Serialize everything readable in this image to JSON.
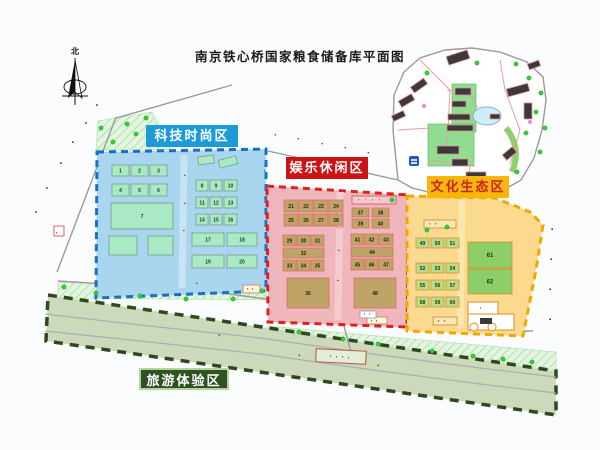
{
  "title": "南京铁心桥国家粮食储备库平面图",
  "compass_north": "北",
  "zones": {
    "tech": {
      "label": "科技时尚区",
      "label_bg": "#1e9bd7",
      "label_color": "#ffffff",
      "fill": "#aad5ee",
      "border": "#1a6fc9"
    },
    "fun": {
      "label": "娱乐休闲区",
      "label_bg": "#cc1414",
      "label_color": "#ffffff",
      "fill": "#efb6bc",
      "border": "#e02020"
    },
    "culture": {
      "label": "文化生态区",
      "label_bg": "#f6b70a",
      "label_color": "#cc2222",
      "fill": "#fbd98f",
      "border": "#f0a800"
    },
    "tour": {
      "label": "旅游体验区",
      "label_bg": "#2f5222",
      "label_color": "#ffffff",
      "fill": "#ccdabb",
      "border": "#2d4a1e"
    }
  },
  "map": {
    "buildings": {
      "bld-tech": {
        "name": "tech-zone-building",
        "fill": "#a9e9c3",
        "stroke": "#7a9c88",
        "text": "#123f22",
        "items": [
          [
            112,
            165,
            17,
            11,
            "1"
          ],
          [
            131,
            165,
            17,
            11,
            "2"
          ],
          [
            150,
            165,
            17,
            11,
            "3"
          ],
          [
            112,
            184,
            17,
            12,
            "4"
          ],
          [
            131,
            184,
            17,
            12,
            "5"
          ],
          [
            150,
            184,
            17,
            12,
            "6"
          ],
          [
            111,
            203,
            62,
            26,
            "7"
          ],
          [
            109,
            236,
            28,
            19,
            ""
          ],
          [
            148,
            236,
            25,
            19,
            ""
          ],
          [
            198,
            156,
            16,
            8,
            "",
            -8
          ],
          [
            219,
            158,
            18,
            8,
            "",
            -15
          ],
          [
            196,
            180,
            12,
            11,
            "8"
          ],
          [
            210,
            180,
            12,
            11,
            "9"
          ],
          [
            224,
            180,
            13,
            11,
            "10"
          ],
          [
            196,
            197,
            12,
            11,
            "11"
          ],
          [
            210,
            197,
            12,
            11,
            "12"
          ],
          [
            224,
            197,
            13,
            11,
            "13"
          ],
          [
            196,
            214,
            12,
            11,
            "14"
          ],
          [
            210,
            214,
            12,
            11,
            "15"
          ],
          [
            224,
            214,
            13,
            11,
            "16"
          ],
          [
            192,
            233,
            32,
            13,
            "17"
          ],
          [
            227,
            233,
            30,
            13,
            "18"
          ],
          [
            192,
            255,
            32,
            13,
            "19"
          ],
          [
            227,
            255,
            30,
            13,
            "20"
          ]
        ]
      },
      "bld-fun": {
        "name": "fun-zone-building",
        "fill": "#bfa468",
        "stroke": "#e06b6b",
        "text": "#2d1f08",
        "items": [
          [
            284,
            200,
            14,
            12,
            "21"
          ],
          [
            299,
            200,
            14,
            12,
            "22"
          ],
          [
            314,
            200,
            14,
            12,
            "23"
          ],
          [
            329,
            200,
            14,
            12,
            "24"
          ],
          [
            284,
            214,
            14,
            12,
            "25"
          ],
          [
            299,
            214,
            14,
            12,
            "26"
          ],
          [
            314,
            214,
            14,
            12,
            "27"
          ],
          [
            329,
            214,
            14,
            12,
            "28"
          ],
          [
            283,
            235,
            13,
            11,
            "29"
          ],
          [
            297,
            235,
            13,
            11,
            "30"
          ],
          [
            311,
            235,
            13,
            11,
            "31"
          ],
          [
            283,
            248,
            41,
            10,
            "32"
          ],
          [
            283,
            260,
            13,
            11,
            "33"
          ],
          [
            297,
            260,
            13,
            11,
            "34"
          ],
          [
            311,
            260,
            13,
            11,
            "35"
          ],
          [
            287,
            278,
            42,
            30,
            "36"
          ],
          [
            352,
            208,
            17,
            9,
            "37"
          ],
          [
            372,
            208,
            17,
            9,
            "38"
          ],
          [
            352,
            219,
            17,
            9,
            "39"
          ],
          [
            372,
            219,
            17,
            9,
            "40"
          ],
          [
            351,
            234,
            13,
            11,
            "41"
          ],
          [
            365,
            234,
            13,
            11,
            "42"
          ],
          [
            379,
            234,
            14,
            11,
            "43"
          ],
          [
            351,
            247,
            42,
            10,
            "44"
          ],
          [
            351,
            259,
            13,
            11,
            "45"
          ],
          [
            365,
            259,
            13,
            11,
            "46"
          ],
          [
            379,
            259,
            14,
            11,
            "47"
          ],
          [
            354,
            278,
            42,
            30,
            "48"
          ]
        ]
      },
      "bld-culture-small": {
        "name": "culture-zone-building",
        "fill": "#b5dd8a",
        "stroke": "#d98f2b",
        "text": "#333300",
        "items": [
          [
            416,
            238,
            13,
            10,
            "49"
          ],
          [
            431,
            238,
            13,
            10,
            "50"
          ],
          [
            446,
            238,
            13,
            10,
            "51"
          ],
          [
            416,
            263,
            13,
            10,
            "52"
          ],
          [
            431,
            263,
            13,
            10,
            "53"
          ],
          [
            446,
            263,
            13,
            10,
            "54"
          ],
          [
            416,
            280,
            13,
            10,
            "55"
          ],
          [
            431,
            280,
            13,
            10,
            "56"
          ],
          [
            446,
            280,
            13,
            10,
            "57"
          ],
          [
            416,
            297,
            13,
            10,
            "58"
          ],
          [
            431,
            297,
            13,
            10,
            "59"
          ],
          [
            446,
            297,
            13,
            10,
            "60"
          ]
        ]
      },
      "bld-culture-large": {
        "name": "culture-zone-field",
        "fill": "#8ccf6a",
        "stroke": "#d98f2b",
        "text": "#333300",
        "font": 6,
        "items": [
          [
            468,
            242,
            44,
            26,
            "61"
          ],
          [
            468,
            269,
            44,
            25,
            "62"
          ]
        ]
      },
      "bld-complex": {
        "name": "northeast-complex-building",
        "fill": "#3a3a3a",
        "stroke": "#e89090",
        "text": "#000000",
        "items": [
          [
            447,
            53,
            22,
            9,
            "",
            -18
          ],
          [
            528,
            62,
            12,
            6,
            "",
            -20
          ],
          [
            411,
            82,
            16,
            7,
            "",
            -35
          ],
          [
            399,
            97,
            15,
            7,
            "",
            -30
          ],
          [
            392,
            113,
            13,
            6,
            "",
            -25
          ],
          [
            455,
            88,
            16,
            7,
            ""
          ],
          [
            452,
            101,
            14,
            6,
            ""
          ],
          [
            448,
            114,
            22,
            6,
            ""
          ],
          [
            447,
            125,
            26,
            6,
            ""
          ],
          [
            437,
            146,
            22,
            8,
            ""
          ],
          [
            452,
            159,
            16,
            7,
            ""
          ],
          [
            507,
            86,
            22,
            8,
            "",
            -15
          ],
          [
            524,
            103,
            8,
            16,
            ""
          ],
          [
            503,
            150,
            13,
            7,
            "",
            -40
          ],
          [
            466,
            172,
            20,
            8,
            ""
          ],
          [
            438,
            177,
            17,
            7,
            ""
          ],
          [
            490,
            114,
            10,
            5,
            ""
          ]
        ]
      }
    },
    "trees": [
      [
        64,
        287
      ],
      [
        96,
        293
      ],
      [
        140,
        296
      ],
      [
        186,
        299
      ],
      [
        233,
        299
      ],
      [
        262,
        291
      ],
      [
        299,
        332
      ],
      [
        343,
        339
      ],
      [
        378,
        344
      ],
      [
        432,
        351
      ],
      [
        473,
        356
      ],
      [
        503,
        359
      ],
      [
        532,
        362
      ],
      [
        101,
        128
      ],
      [
        113,
        142
      ],
      [
        127,
        124
      ],
      [
        146,
        118
      ],
      [
        158,
        142
      ],
      [
        136,
        134
      ],
      [
        516,
        64
      ],
      [
        529,
        78
      ],
      [
        541,
        93
      ],
      [
        536,
        112
      ],
      [
        526,
        133
      ],
      [
        540,
        152
      ],
      [
        517,
        172
      ],
      [
        477,
        63
      ],
      [
        427,
        73
      ],
      [
        463,
        188
      ],
      [
        499,
        186
      ],
      [
        545,
        128
      ],
      [
        427,
        230
      ],
      [
        447,
        227
      ],
      [
        392,
        200
      ]
    ],
    "flowers": [
      [
        530,
        122
      ],
      [
        507,
        180
      ],
      [
        478,
        191
      ],
      [
        424,
        106
      ]
    ],
    "marks": {
      "left-road-name": {
        "name": "road-name-character",
        "glyph": "▪",
        "color": "#1c1c1c",
        "size": 6,
        "items": [
          [
            95,
            106,
            35
          ],
          [
            84,
            124,
            35
          ],
          [
            71,
            143,
            35
          ],
          [
            59,
            164,
            35
          ],
          [
            45,
            189,
            35
          ],
          [
            34,
            213,
            35
          ]
        ]
      },
      "mid-road-name": {
        "name": "road-name-character",
        "glyph": "▪",
        "color": "#1c1c1c",
        "size": 5,
        "items": [
          [
            274,
            136,
            15
          ],
          [
            297,
            140,
            15
          ],
          [
            321,
            145,
            15
          ],
          [
            344,
            149,
            15
          ],
          [
            367,
            154,
            15
          ]
        ]
      },
      "right-road-name": {
        "name": "road-name-character",
        "glyph": "▪",
        "color": "#1c1c1c",
        "size": 6,
        "items": [
          [
            551,
            231,
            0
          ],
          [
            550,
            261,
            0
          ],
          [
            549,
            291,
            0
          ],
          [
            549,
            321,
            0
          ]
        ]
      },
      "river-name": {
        "name": "river-name-character",
        "glyph": "▪",
        "color": "#4a5a4a",
        "size": 6,
        "items": [
          [
            218,
            337,
            10
          ],
          [
            298,
            357,
            10
          ],
          [
            377,
            367,
            10
          ]
        ]
      },
      "tech-lane-name": {
        "name": "inner-road-character",
        "glyph": "▪",
        "color": "#333333",
        "size": 5,
        "items": [
          [
            184,
            177,
            0
          ],
          [
            184,
            205,
            0
          ],
          [
            183,
            232,
            0
          ],
          [
            196,
            285,
            0
          ]
        ]
      },
      "fun-lane-name": {
        "name": "inner-road-character",
        "glyph": "▪",
        "color": "#333333",
        "size": 5,
        "items": [
          [
            338,
            252,
            0
          ],
          [
            337,
            282,
            0
          ]
        ]
      },
      "small-label-text": {
        "name": "small-label-character",
        "glyph": "▪",
        "color": "#222222",
        "size": 4,
        "items": [
          [
            247,
            290,
            0
          ],
          [
            252,
            290,
            0
          ],
          [
            330,
            357,
            0
          ],
          [
            336,
            358,
            0
          ],
          [
            342,
            358,
            0
          ],
          [
            348,
            359,
            0
          ],
          [
            429,
            225,
            0
          ],
          [
            435,
            225,
            0
          ],
          [
            438,
            322,
            0
          ],
          [
            444,
            322,
            0
          ],
          [
            371,
            322,
            0
          ],
          [
            376,
            322,
            0
          ],
          [
            364,
            315,
            0
          ],
          [
            369,
            315,
            0
          ],
          [
            480,
            309,
            0
          ],
          [
            485,
            322,
            0
          ],
          [
            56,
            234,
            0
          ],
          [
            264,
            172,
            0
          ]
        ]
      },
      "red-band-text": {
        "name": "small-label-character",
        "glyph": "▪",
        "color": "#cc3333",
        "size": 4,
        "items": [
          [
            358,
            201,
            0
          ],
          [
            365,
            201,
            0
          ],
          [
            372,
            201,
            0
          ],
          [
            379,
            201,
            0
          ]
        ]
      }
    }
  }
}
